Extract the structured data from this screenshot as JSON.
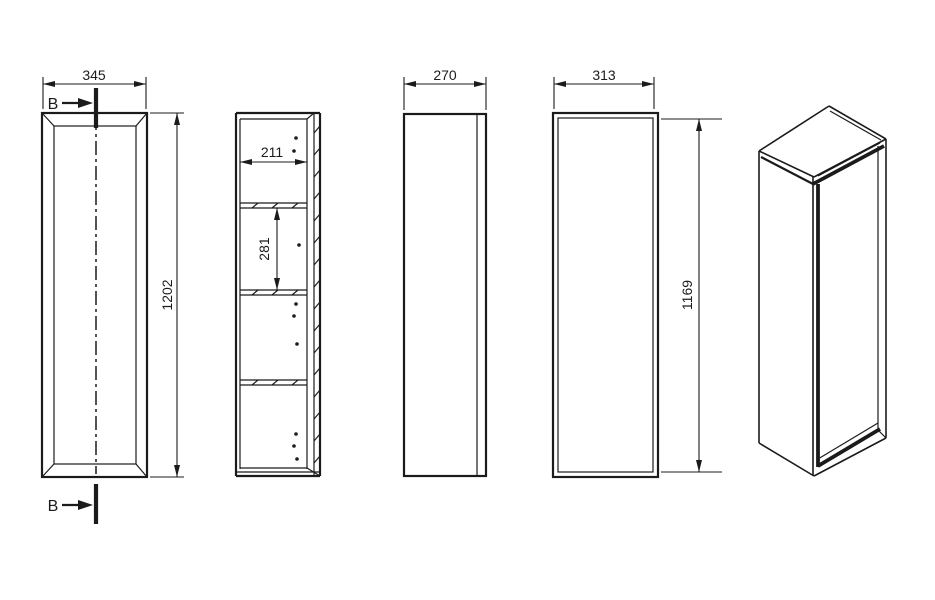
{
  "colors": {
    "line": "#1b1b1b",
    "background": "#ffffff"
  },
  "front_view": {
    "width": "345",
    "height": "1202",
    "section_marker": "B"
  },
  "section_view": {
    "inner_width": "211",
    "compartment_height": "281"
  },
  "side_view": {
    "depth": "270"
  },
  "back_view": {
    "width": "313",
    "height": "1169"
  }
}
